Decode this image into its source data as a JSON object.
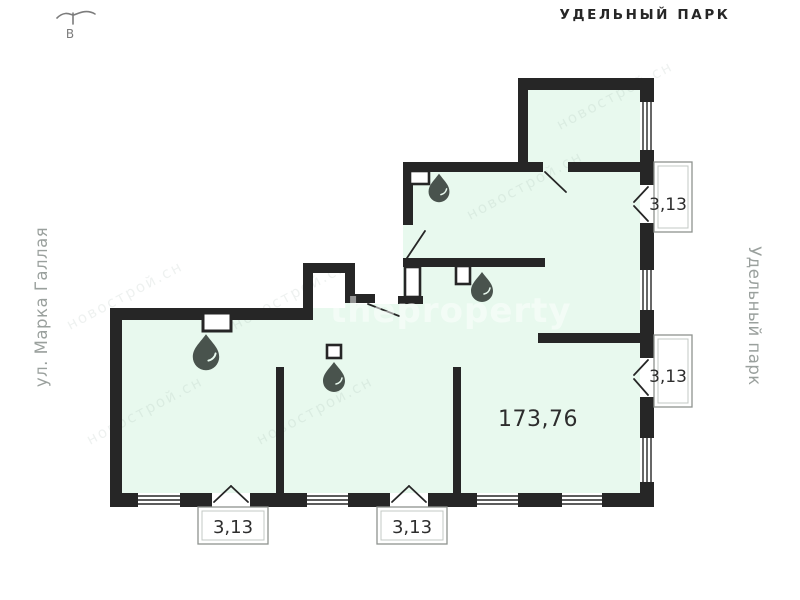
{
  "header": {
    "park_label": "УДЕЛЬНЫЙ ПАРК"
  },
  "sides": {
    "street_left": "ул. Марка Галлая",
    "park_right": "Удельный парк"
  },
  "compass": {
    "east_letter": "В"
  },
  "plan": {
    "total_area": "173,76",
    "balcony_right_top_area": "3,13",
    "balcony_right_middle_area": "3,13",
    "balcony_bottom_left_area": "3,13",
    "balcony_bottom_middle_area": "3,13"
  },
  "watermark": {
    "brand": "theproperty",
    "ghost": "новострой.сн"
  },
  "colors": {
    "floor": "#e8f9ee",
    "wall": "#262626",
    "balcony_outline": "#8e938f",
    "side_label": "#9aa09d",
    "drop_icon": "#49534d",
    "text": "#2d2d2d"
  }
}
